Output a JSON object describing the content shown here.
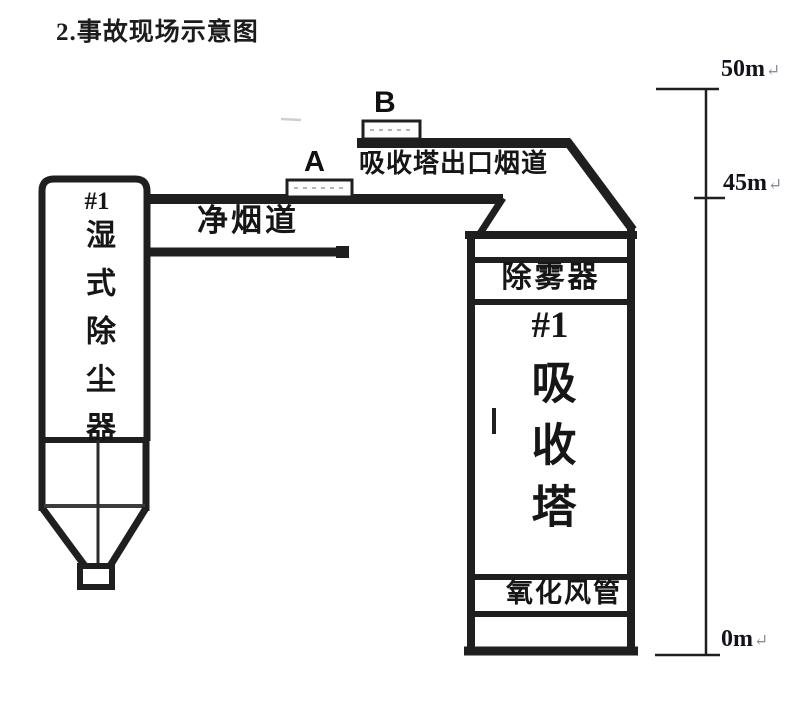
{
  "title": "2.事故现场示意图",
  "diagram": {
    "marker_a": "A",
    "marker_b": "B",
    "clean_flue_label": "净烟道",
    "outlet_flue_label": "吸收塔出口烟道",
    "wet_dust_collector": {
      "unit": "#1",
      "name": "湿式除尘器"
    },
    "absorber": {
      "demister": "除雾器",
      "unit": "#1",
      "name": "吸收塔",
      "oxidation_air_pipe": "氧化风管"
    },
    "elevation_scale": {
      "marks": [
        {
          "label": "50m"
        },
        {
          "label": "45m"
        },
        {
          "label": "0m"
        }
      ],
      "paragraph_mark": "↵"
    }
  },
  "colors": {
    "ink": "#1f1f1f",
    "paper": "#ffffff",
    "paragraph_mark": "#8d8d9b"
  }
}
